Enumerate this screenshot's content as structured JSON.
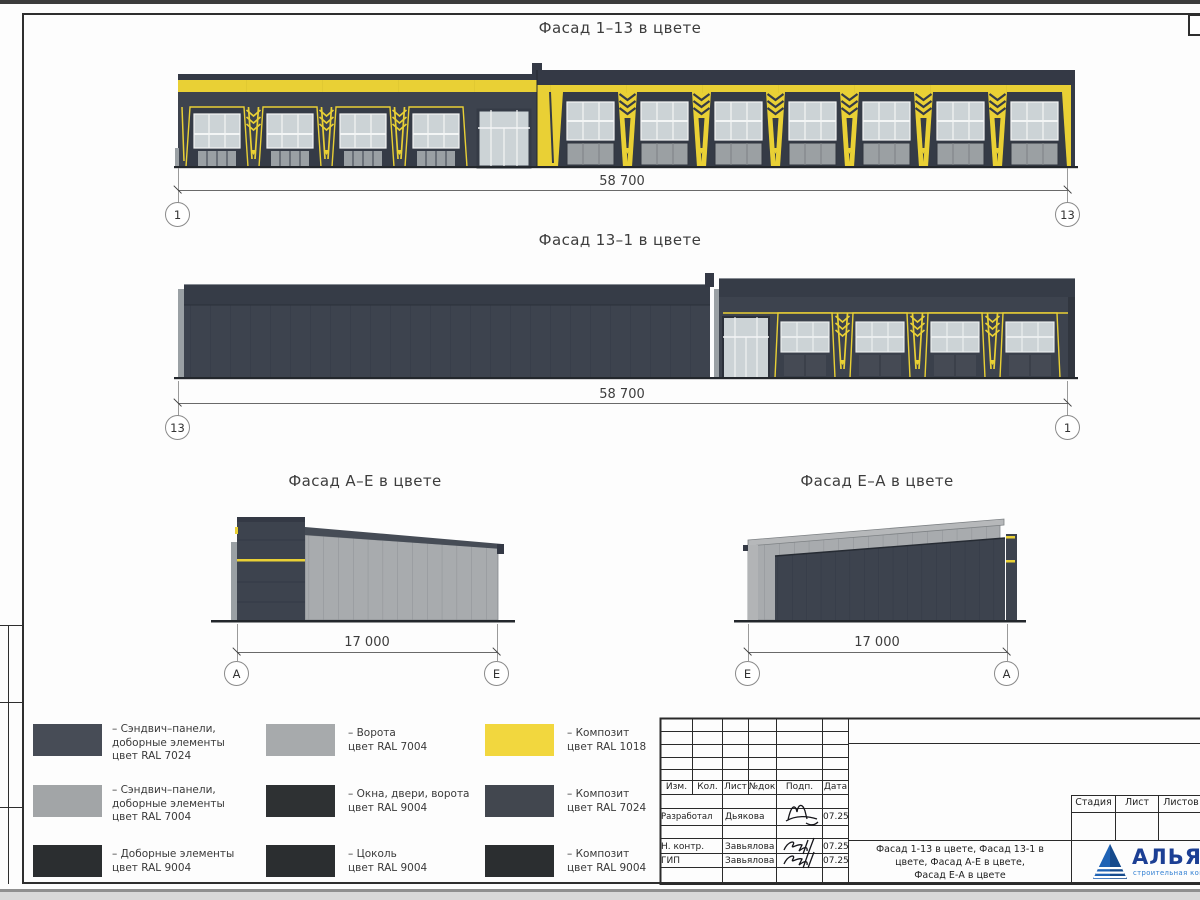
{
  "views": [
    {
      "title": "Фасад 1–13 в цвете",
      "dim": "58 700",
      "axis_left": "1",
      "axis_right": "13"
    },
    {
      "title": "Фасад 13–1 в цвете",
      "dim": "58 700",
      "axis_left": "13",
      "axis_right": "1"
    },
    {
      "title": "Фасад А–Е в цвете",
      "dim": "17 000",
      "axis_left": "А",
      "axis_right": "Е"
    },
    {
      "title": "Фасад Е–А в цвете",
      "dim": "17 000",
      "axis_left": "Е",
      "axis_right": "А"
    }
  ],
  "legend": {
    "items": [
      {
        "color": "#474c56",
        "lines": [
          "– Сэндвич–панели,",
          "доборные элементы",
          "цвет RAL 7024"
        ]
      },
      {
        "color": "#a2a5a7",
        "lines": [
          "– Сэндвич–панели,",
          "доборные элементы",
          "цвет RAL 7004"
        ]
      },
      {
        "color": "#2b2e30",
        "lines": [
          "– Доборные элементы",
          "цвет RAL 9004"
        ]
      },
      {
        "color": "#a7aaac",
        "lines": [
          "– Ворота",
          "цвет RAL 7004"
        ]
      },
      {
        "color": "#2e3133",
        "lines": [
          "– Окна, двери, ворота",
          "цвет RAL 9004"
        ]
      },
      {
        "color": "#2b2e30",
        "lines": [
          "– Цоколь",
          "цвет RAL 9004"
        ]
      },
      {
        "color": "#f2d73e",
        "lines": [
          "– Композит",
          "цвет RAL 1018"
        ]
      },
      {
        "color": "#42474f",
        "lines": [
          "– Композит",
          "цвет RAL 7024"
        ]
      },
      {
        "color": "#2b2e30",
        "lines": [
          "– Композит",
          "цвет RAL 9004"
        ]
      }
    ]
  },
  "titleblock": {
    "header_cols": [
      "Изм.",
      "Кол.",
      "Лист",
      "№док",
      "Подп.",
      "Дата"
    ],
    "sign_rows": [
      {
        "role": "Разработал",
        "name": "Дьякова",
        "date": "07.25"
      },
      {
        "role": "Н. контр.",
        "name": "Завьялова",
        "date": "07.25"
      },
      {
        "role": "ГИП",
        "name": "Завьялова",
        "date": "07.25"
      }
    ],
    "doc_title_lines": [
      "Фасад 1-13 в цвете, Фасад 13-1 в",
      "цвете, Фасад А-Е в цвете,",
      "Фасад Е-А в цвете"
    ],
    "stage_cols": [
      "Стадия",
      "Лист",
      "Листов"
    ],
    "company": {
      "name": "АЛЬЯНС",
      "tagline": "строительная компания"
    }
  },
  "palette": {
    "ral_7024": "#3d434e",
    "ral_7004": "#a8abae",
    "ral_9004": "#2b2e30",
    "ral_1018": "#e9d035"
  }
}
